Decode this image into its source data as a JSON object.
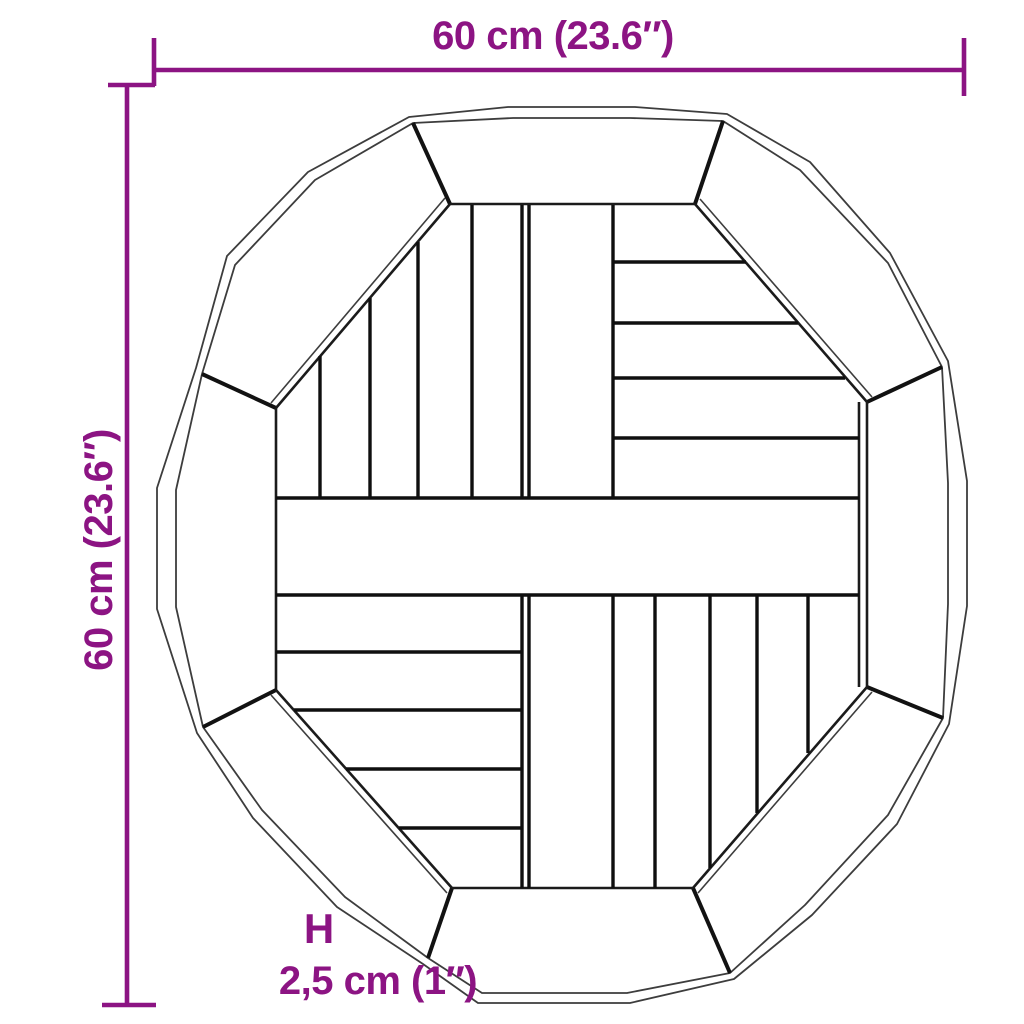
{
  "diagram": {
    "labels": {
      "width": "60 cm (23.6″)",
      "height": "60 cm (23.6″)",
      "thickness_symbol": "H",
      "thickness": "2,5 cm (1″)"
    },
    "colors": {
      "accent": "#8C1483",
      "line": "#1a1a1a",
      "background": "#ffffff"
    }
  }
}
